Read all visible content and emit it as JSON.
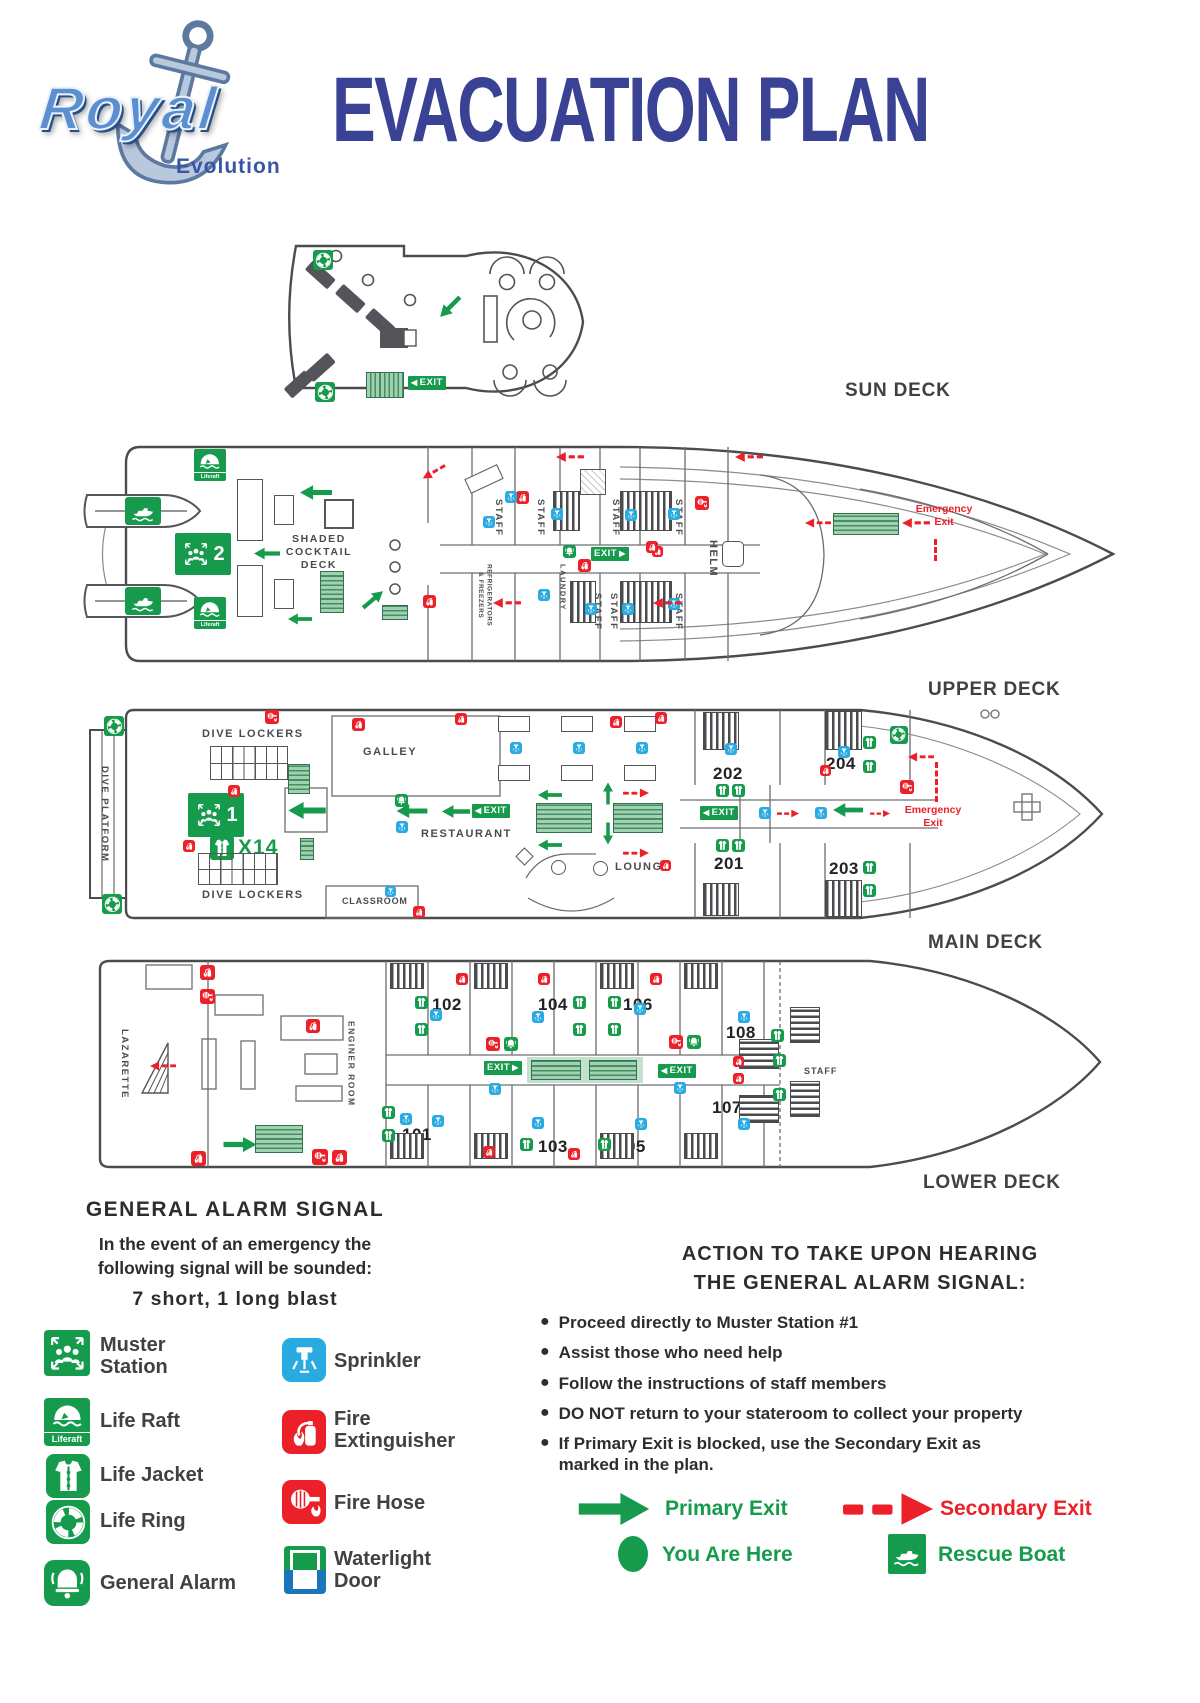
{
  "header": {
    "logo_title": "Royal",
    "logo_subtitle": "Evolution",
    "title": "EVACUATION PLAN"
  },
  "labels": {
    "exit": "EXIT",
    "liferaft": "Liferaft",
    "emergency_exit": "Emergency\nExit"
  },
  "decks": {
    "sun": {
      "name": "SUN DECK"
    },
    "upper": {
      "name": "UPPER DECK",
      "muster_number": "2",
      "shaded_cocktail_deck": "SHADED\nCOCKTAIL\nDECK",
      "staff": "STAFF",
      "helm": "HELM",
      "refrigerators": "REFRIGERATORS\n& FREEZERS",
      "laundry": "LAUNDRY"
    },
    "main": {
      "name": "MAIN DECK",
      "muster_number": "1",
      "life_jacket_count": "X14",
      "dive_platform": "DIVE PLATFORM",
      "dive_lockers": "DIVE LOCKERS",
      "galley": "GALLEY",
      "restaurant": "RESTAURANT",
      "lounge": "LOUNGE",
      "classroom": "CLASSROOM",
      "cabin_201": "201",
      "cabin_202": "202",
      "cabin_203": "203",
      "cabin_204": "204"
    },
    "lower": {
      "name": "LOWER DECK",
      "lazarette": "LAZARETTE",
      "engine_room": "ENGINER ROOM",
      "staff": "STAFF",
      "cabin_101": "101",
      "cabin_102": "102",
      "cabin_103": "103",
      "cabin_104": "104",
      "cabin_105": "105",
      "cabin_106": "106",
      "cabin_107": "107",
      "cabin_108": "108"
    }
  },
  "alarm_signal": {
    "title": "GENERAL ALARM SIGNAL",
    "body": "In the event of an emergency the\nfollowing signal will be sounded:",
    "blast": "7 short, 1 long blast"
  },
  "legend_left": [
    {
      "icon": "muster-station-icon",
      "label": "Muster\nStation"
    },
    {
      "icon": "life-raft-icon",
      "label": "Life Raft"
    },
    {
      "icon": "life-jacket-icon",
      "label": "Life Jacket"
    },
    {
      "icon": "life-ring-icon",
      "label": "Life Ring"
    },
    {
      "icon": "general-alarm-icon",
      "label": "General Alarm"
    }
  ],
  "legend_right": [
    {
      "icon": "sprinkler-icon",
      "label": "Sprinkler"
    },
    {
      "icon": "fire-extinguisher-icon",
      "label": "Fire\nExtinguisher"
    },
    {
      "icon": "fire-hose-icon",
      "label": "Fire Hose"
    },
    {
      "icon": "waterlight-door-icon",
      "label": "Waterlight\nDoor"
    }
  ],
  "actions": {
    "title": "ACTION TO TAKE UPON HEARING\nTHE GENERAL ALARM SIGNAL:",
    "bullets": [
      "Proceed directly to Muster Station #1",
      "Assist those who need help",
      "Follow the instructions of staff members",
      "DO NOT return to your stateroom to collect your property",
      "If Primary Exit is blocked, use the Secondary Exit as\nmarked in the plan."
    ]
  },
  "exit_legend": {
    "primary": "Primary Exit",
    "secondary": "Secondary Exit",
    "you_are_here": "You Are Here",
    "rescue_boat": "Rescue Boat"
  },
  "colors": {
    "safety_green": "#169b4c",
    "safety_red": "#ec2028",
    "sprinkler_blue": "#29abe2",
    "door_blue": "#1b75bb",
    "title_blue": "#3a4296",
    "ink": "#414042"
  }
}
